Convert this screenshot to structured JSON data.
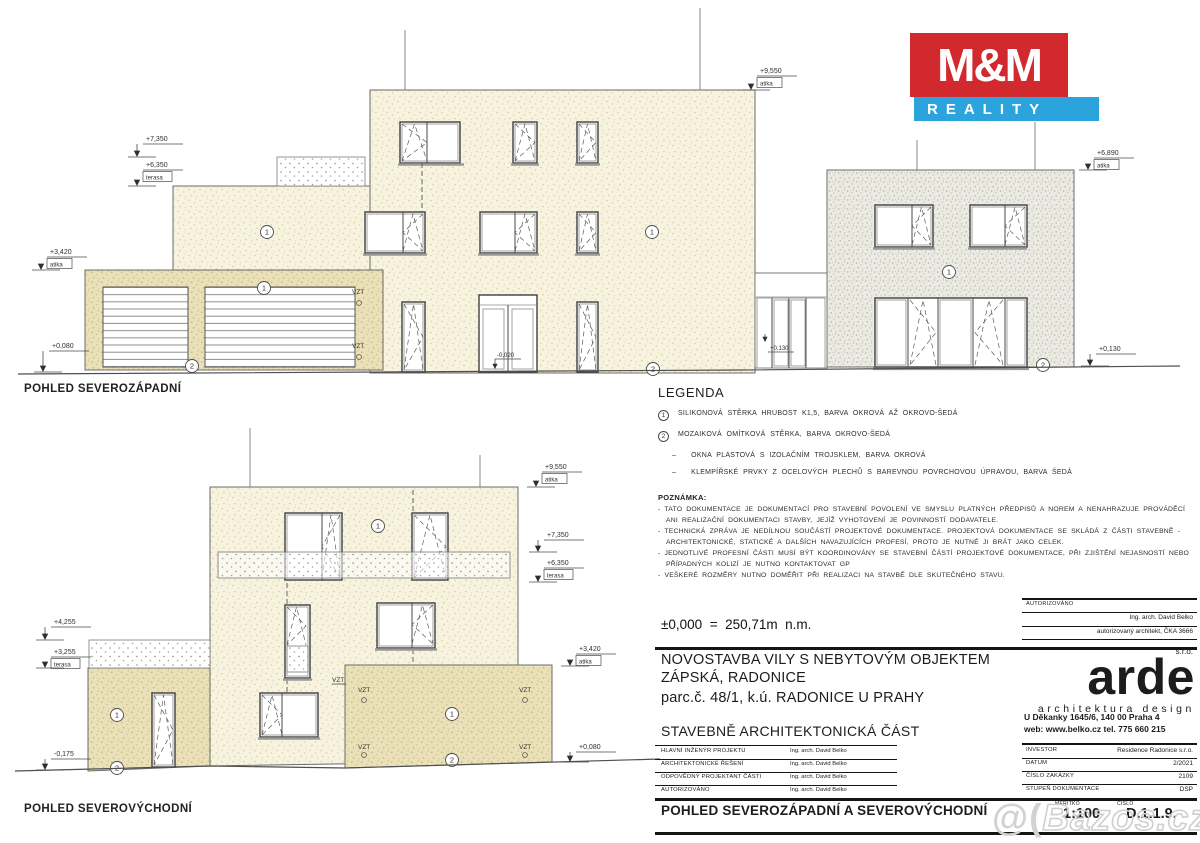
{
  "views": {
    "v1": {
      "title": "POHLED SEVEROZÁPADNÍ"
    },
    "v2": {
      "title": "POHLED SEVEROVÝCHODNÍ"
    }
  },
  "terms": {
    "atika": "atika",
    "terasa": "terasa",
    "vzt": "VZT",
    "m1": "1",
    "m2": "2"
  },
  "dims": {
    "v1_9550": "+9,550",
    "v1_7350": "+7,350",
    "v1_6350": "+6,350",
    "v1_3420": "+3,420",
    "v1_0080": "+0,080",
    "v1_6890": "+6,890",
    "v1_0130_right": "+0,130",
    "v1_0130_doors": "+0,130",
    "v1_m0020": "-0,020",
    "v2_9550": "+9,550",
    "v2_7350": "+7,350",
    "v2_6350": "+6,350",
    "v2_3420": "+3,420",
    "v2_0080": "+0,080",
    "v2_4255": "+4,255",
    "v2_3255": "+3,255",
    "v2_m0175": "-0,175"
  },
  "legend": {
    "title": "LEGENDA",
    "items": [
      {
        "marker": "1",
        "text": "SILIKONOVÁ STĚRKA HRUBOST K1,5, BARVA OKROVÁ AŽ OKROVO-ŠEDÁ"
      },
      {
        "marker": "2",
        "text": "MOZAIKOVÁ OMÍTKOVÁ STĚRKA, BARVA OKROVO-ŠEDÁ"
      },
      {
        "marker": "–",
        "text": "OKNA PLASTOVÁ S IZOLAČNÍM TROJSKLEM, BARVA OKROVÁ"
      },
      {
        "marker": "–",
        "text": "KLEMPÍŘSKÉ PRVKY Z OCELOVÝCH PLECHŮ S BAREVNOU POVRCHOVOU ÚPRAVOU, BARVA ŠEDÁ"
      }
    ]
  },
  "notes": {
    "title": "POZNÁMKA:",
    "items": [
      "- TATO DOKUMENTACE JE DOKUMENTACÍ PRO STAVEBNÍ POVOLENÍ VE SMYSLU PLATNÝCH PŘEDPISŮ A NOREM A NENAHRAZUJE PROVÁDĚCÍ ANI REALIZAČNÍ DOKUMENTACI STAVBY, JEJÍŽ VYHOTOVENÍ JE POVINNOSTÍ DODAVATELE.",
      "- TECHNICKÁ ZPRÁVA JE NEDÍLNOU SOUČÁSTÍ PROJEKTOVÉ DOKUMENTACE. PROJEKTOVÁ DOKUMENTACE SE SKLÁDÁ Z ČÁSTI STAVEBNĚ - ARCHITEKTONICKÉ, STATICKÉ A DALŠÍCH NAVAZUJÍCÍCH PROFESÍ, PROTO JE NUTNÉ JI BRÁT JAKO CELEK.",
      "- JEDNOTLIVÉ PROFESNÍ ČÁSTI MUSÍ BÝT KOORDINOVÁNY SE STAVEBNÍ ČÁSTÍ PROJEKTOVÉ DOKUMENTACE, PŘI ZJIŠTĚNÍ NEJASNOSTÍ NEBO PŘÍPADNÝCH KOLIZÍ JE NUTNO KONTAKTOVAT GP",
      "- VEŠKERÉ ROZMĚRY NUTNO DOMĚŘIT PŘI REALIZACI NA STAVBĚ DLE SKUTEČNÉHO STAVU."
    ]
  },
  "datum_line": "±0,000  =  250,71m  n.m.",
  "title_block": {
    "auth": {
      "label": "AUTORIZOVÁNO",
      "name": "Ing. arch. David Belko",
      "cert": "autorizovaný architekt, ČKA 3666"
    },
    "project": {
      "line1": "NOVOSTAVBA VILY S NEBYTOVÝM OBJEKTEM",
      "line2": "ZÁPSKÁ, RADONICE",
      "line3": "parc.č. 48/1, k.ú. RADONICE U PRAHY",
      "part": "STAVEBNĚ ARCHITEKTONICKÁ ČÁST"
    },
    "roles": [
      {
        "label": "HLAVNÍ INŽENÝR PROJEKTU",
        "value": "Ing. arch. David Belko"
      },
      {
        "label": "ARCHITEKTONICKÉ ŘEŠENÍ",
        "value": "Ing. arch. David Belko"
      },
      {
        "label": "ODPOVĚDNÝ PROJEKTANT ČÁSTI",
        "value": "Ing. arch. David Belko"
      },
      {
        "label": "AUTORIZOVÁNO",
        "value": "Ing. arch. David Belko"
      }
    ],
    "firm": {
      "name": "arde",
      "suffix": "s.r.o.",
      "tagline": "architektura design",
      "address": "U Děkanky 1645/6, 140 00 Praha 4",
      "contact": "web: www.belko.cz  tel. 775 660 215"
    },
    "meta": [
      {
        "label": "INVESTOR",
        "value": "Residence Radonice s.r.o."
      },
      {
        "label": "DATUM",
        "value": "2/2021"
      },
      {
        "label": "ČÍSLO ZAKÁZKY",
        "value": "2109"
      },
      {
        "label": "STUPEŇ DOKUMENTACE",
        "value": "DSP"
      }
    ],
    "sheet": {
      "title": "POHLED SEVEROZÁPADNÍ A SEVEROVÝCHODNÍ",
      "scale_label": "MĚŘÍTKO",
      "scale": "1:100",
      "number_label": "ČÍSLO",
      "number": "D.1.1.9."
    }
  },
  "logo_mm": {
    "top": "M&M",
    "bottom": "REALITY",
    "red": "#d2292f",
    "blue": "#2ba4dd"
  },
  "watermark": {
    "prefix": "@(",
    "text": "Bazos.cz"
  },
  "colors": {
    "facade_cream": "#f7f3de",
    "facade_ochre": "#ebe1b8",
    "facade_grey": "#ebebe4"
  }
}
